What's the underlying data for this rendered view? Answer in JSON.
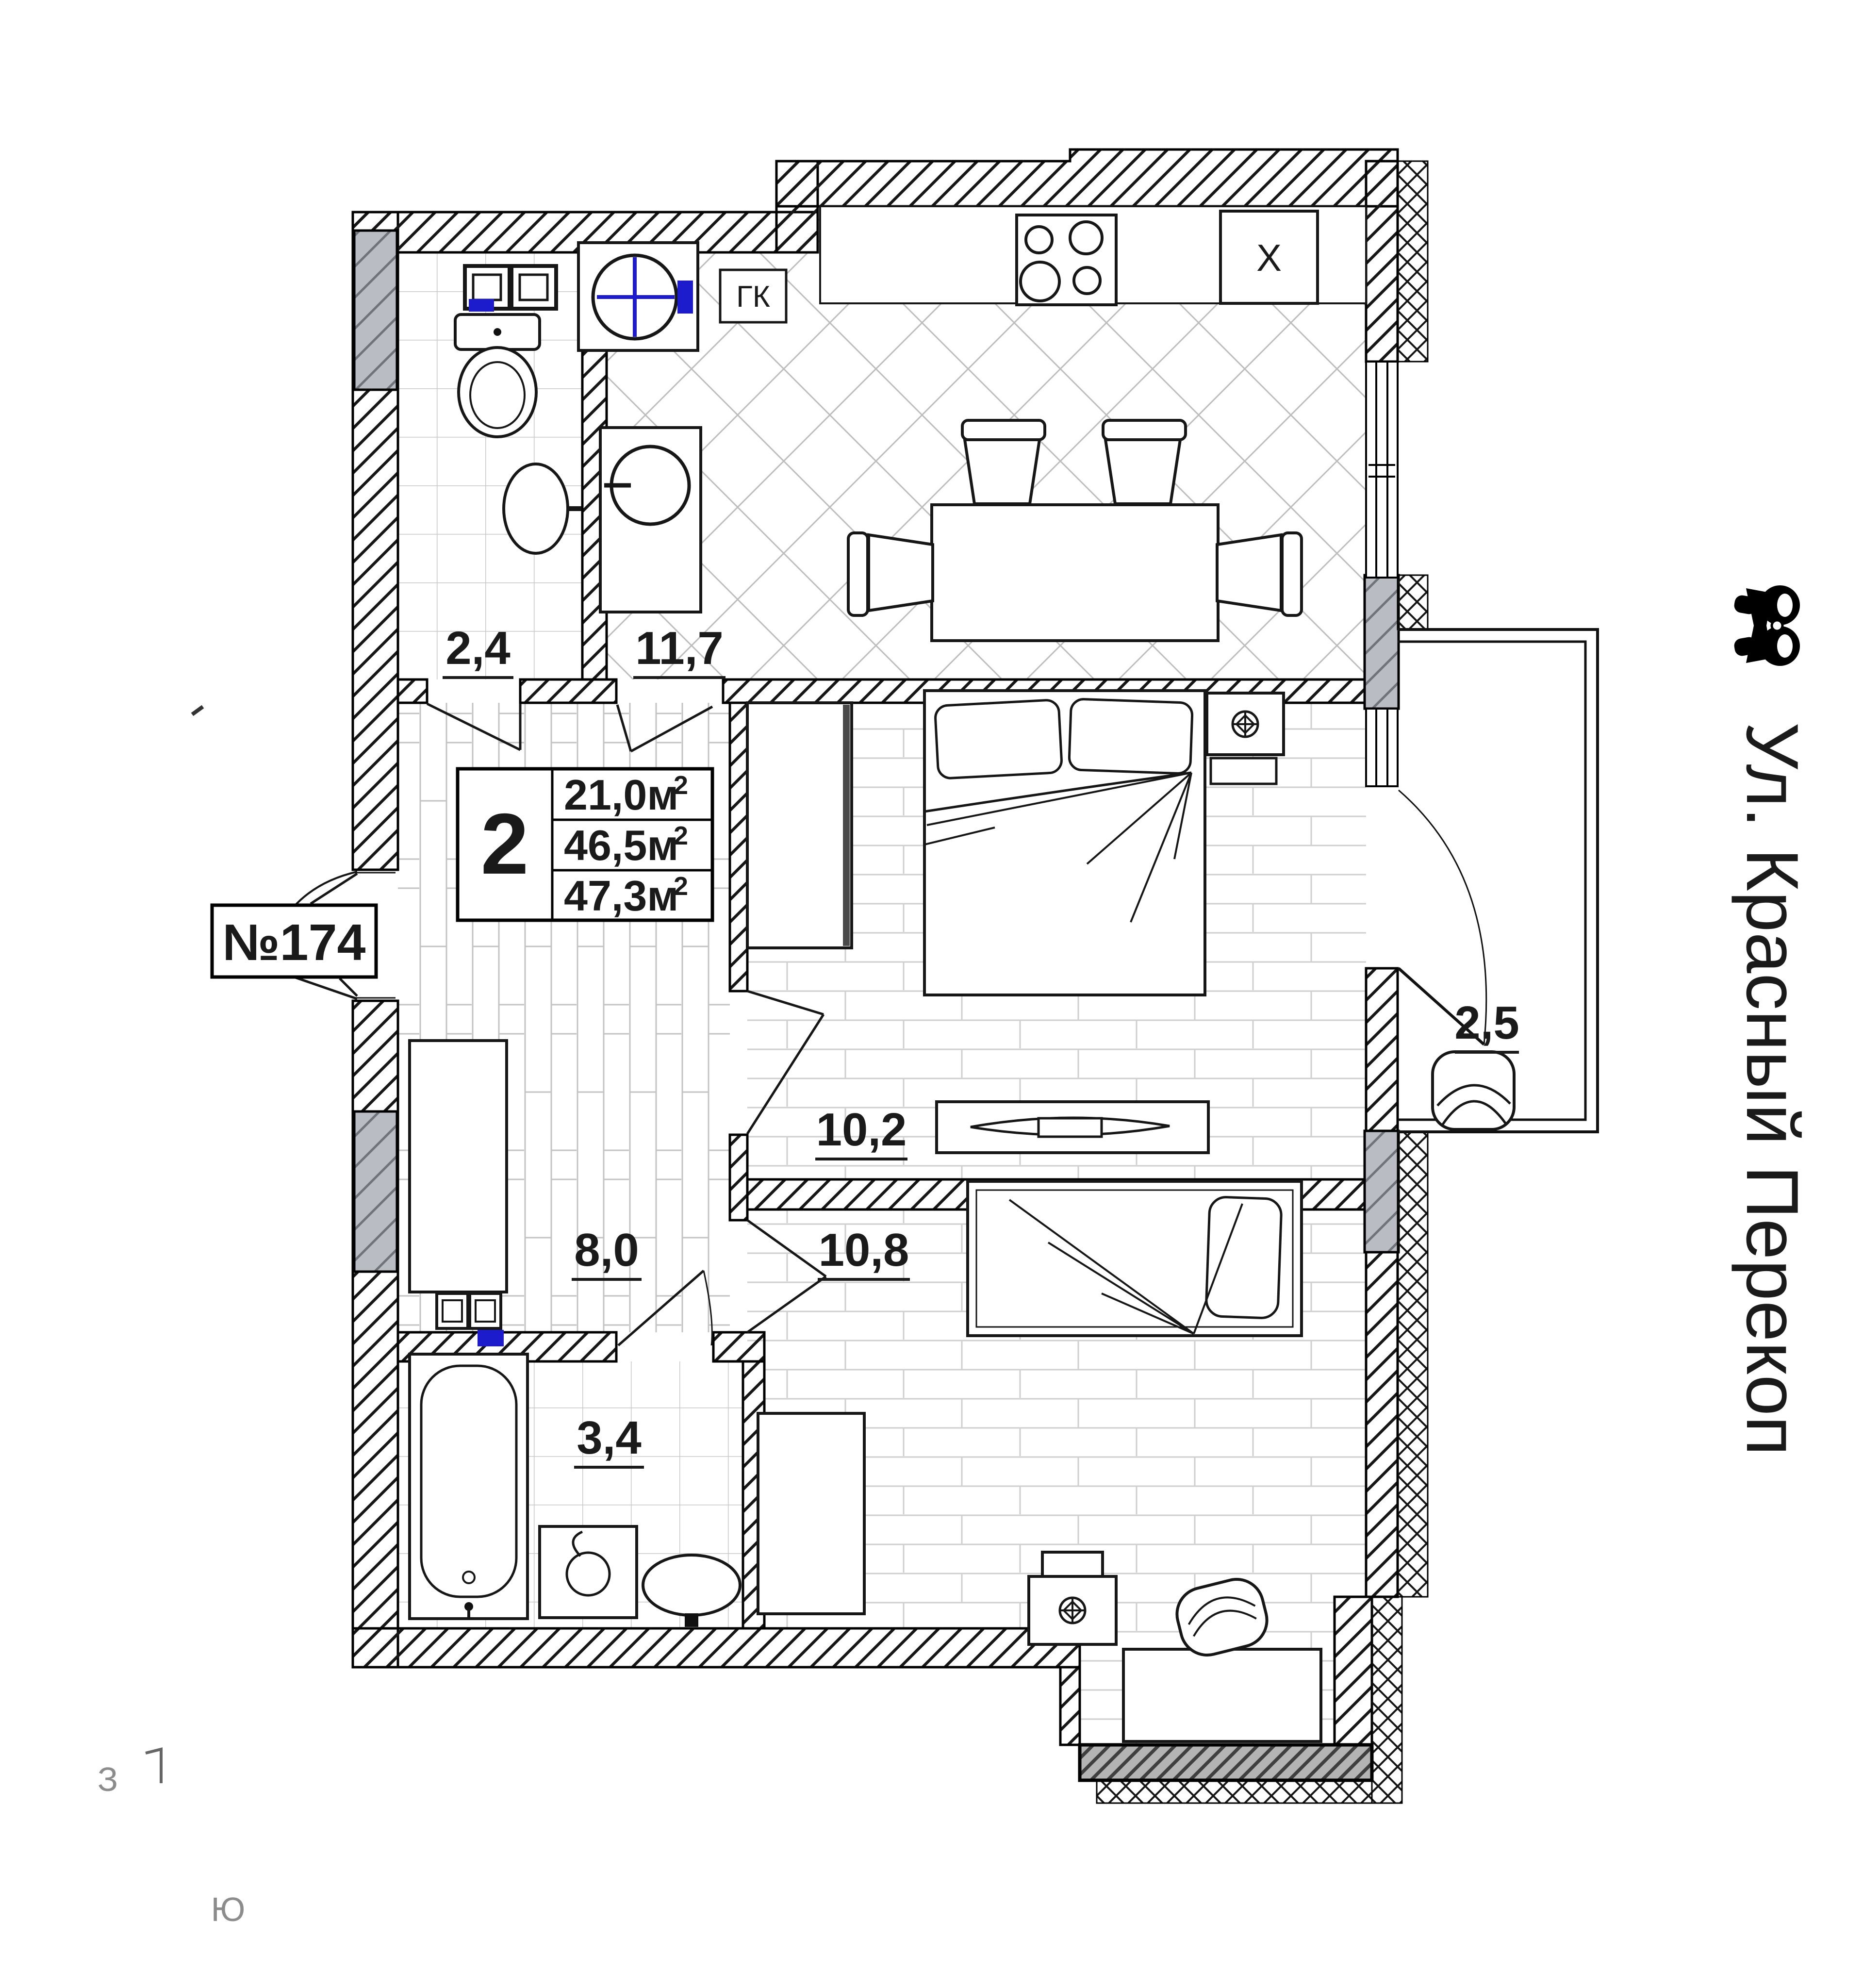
{
  "colors": {
    "accent_blue": "#1c1ccd",
    "pilaster_grey": "#b9bdc3",
    "band_grey": "#b4b4b4",
    "compass_grey": "#8c8c8c",
    "ink": "#1a1a1a"
  },
  "title_block": {
    "rooms_count": "2",
    "areas": [
      {
        "name": "living_area",
        "text": "21,0м",
        "sup": "2"
      },
      {
        "name": "apartment_area",
        "text": "46,5м",
        "sup": "2"
      },
      {
        "name": "total_area_with_balcony",
        "text": "47,3м",
        "sup": "2"
      }
    ]
  },
  "apartment_number": "№174",
  "room_labels": {
    "wc": "2,4",
    "kitchen": "11,7",
    "hall": "8,0",
    "bedroom_1": "10,2",
    "bedroom_2": "10,8",
    "bathroom": "3,4",
    "balcony": "2,5"
  },
  "equipment_labels": {
    "gas_boiler": "ГК",
    "fridge": "X"
  },
  "compass": {
    "west": "З",
    "south": "Ю"
  },
  "street_label": "Ул. Красный Перекоп"
}
